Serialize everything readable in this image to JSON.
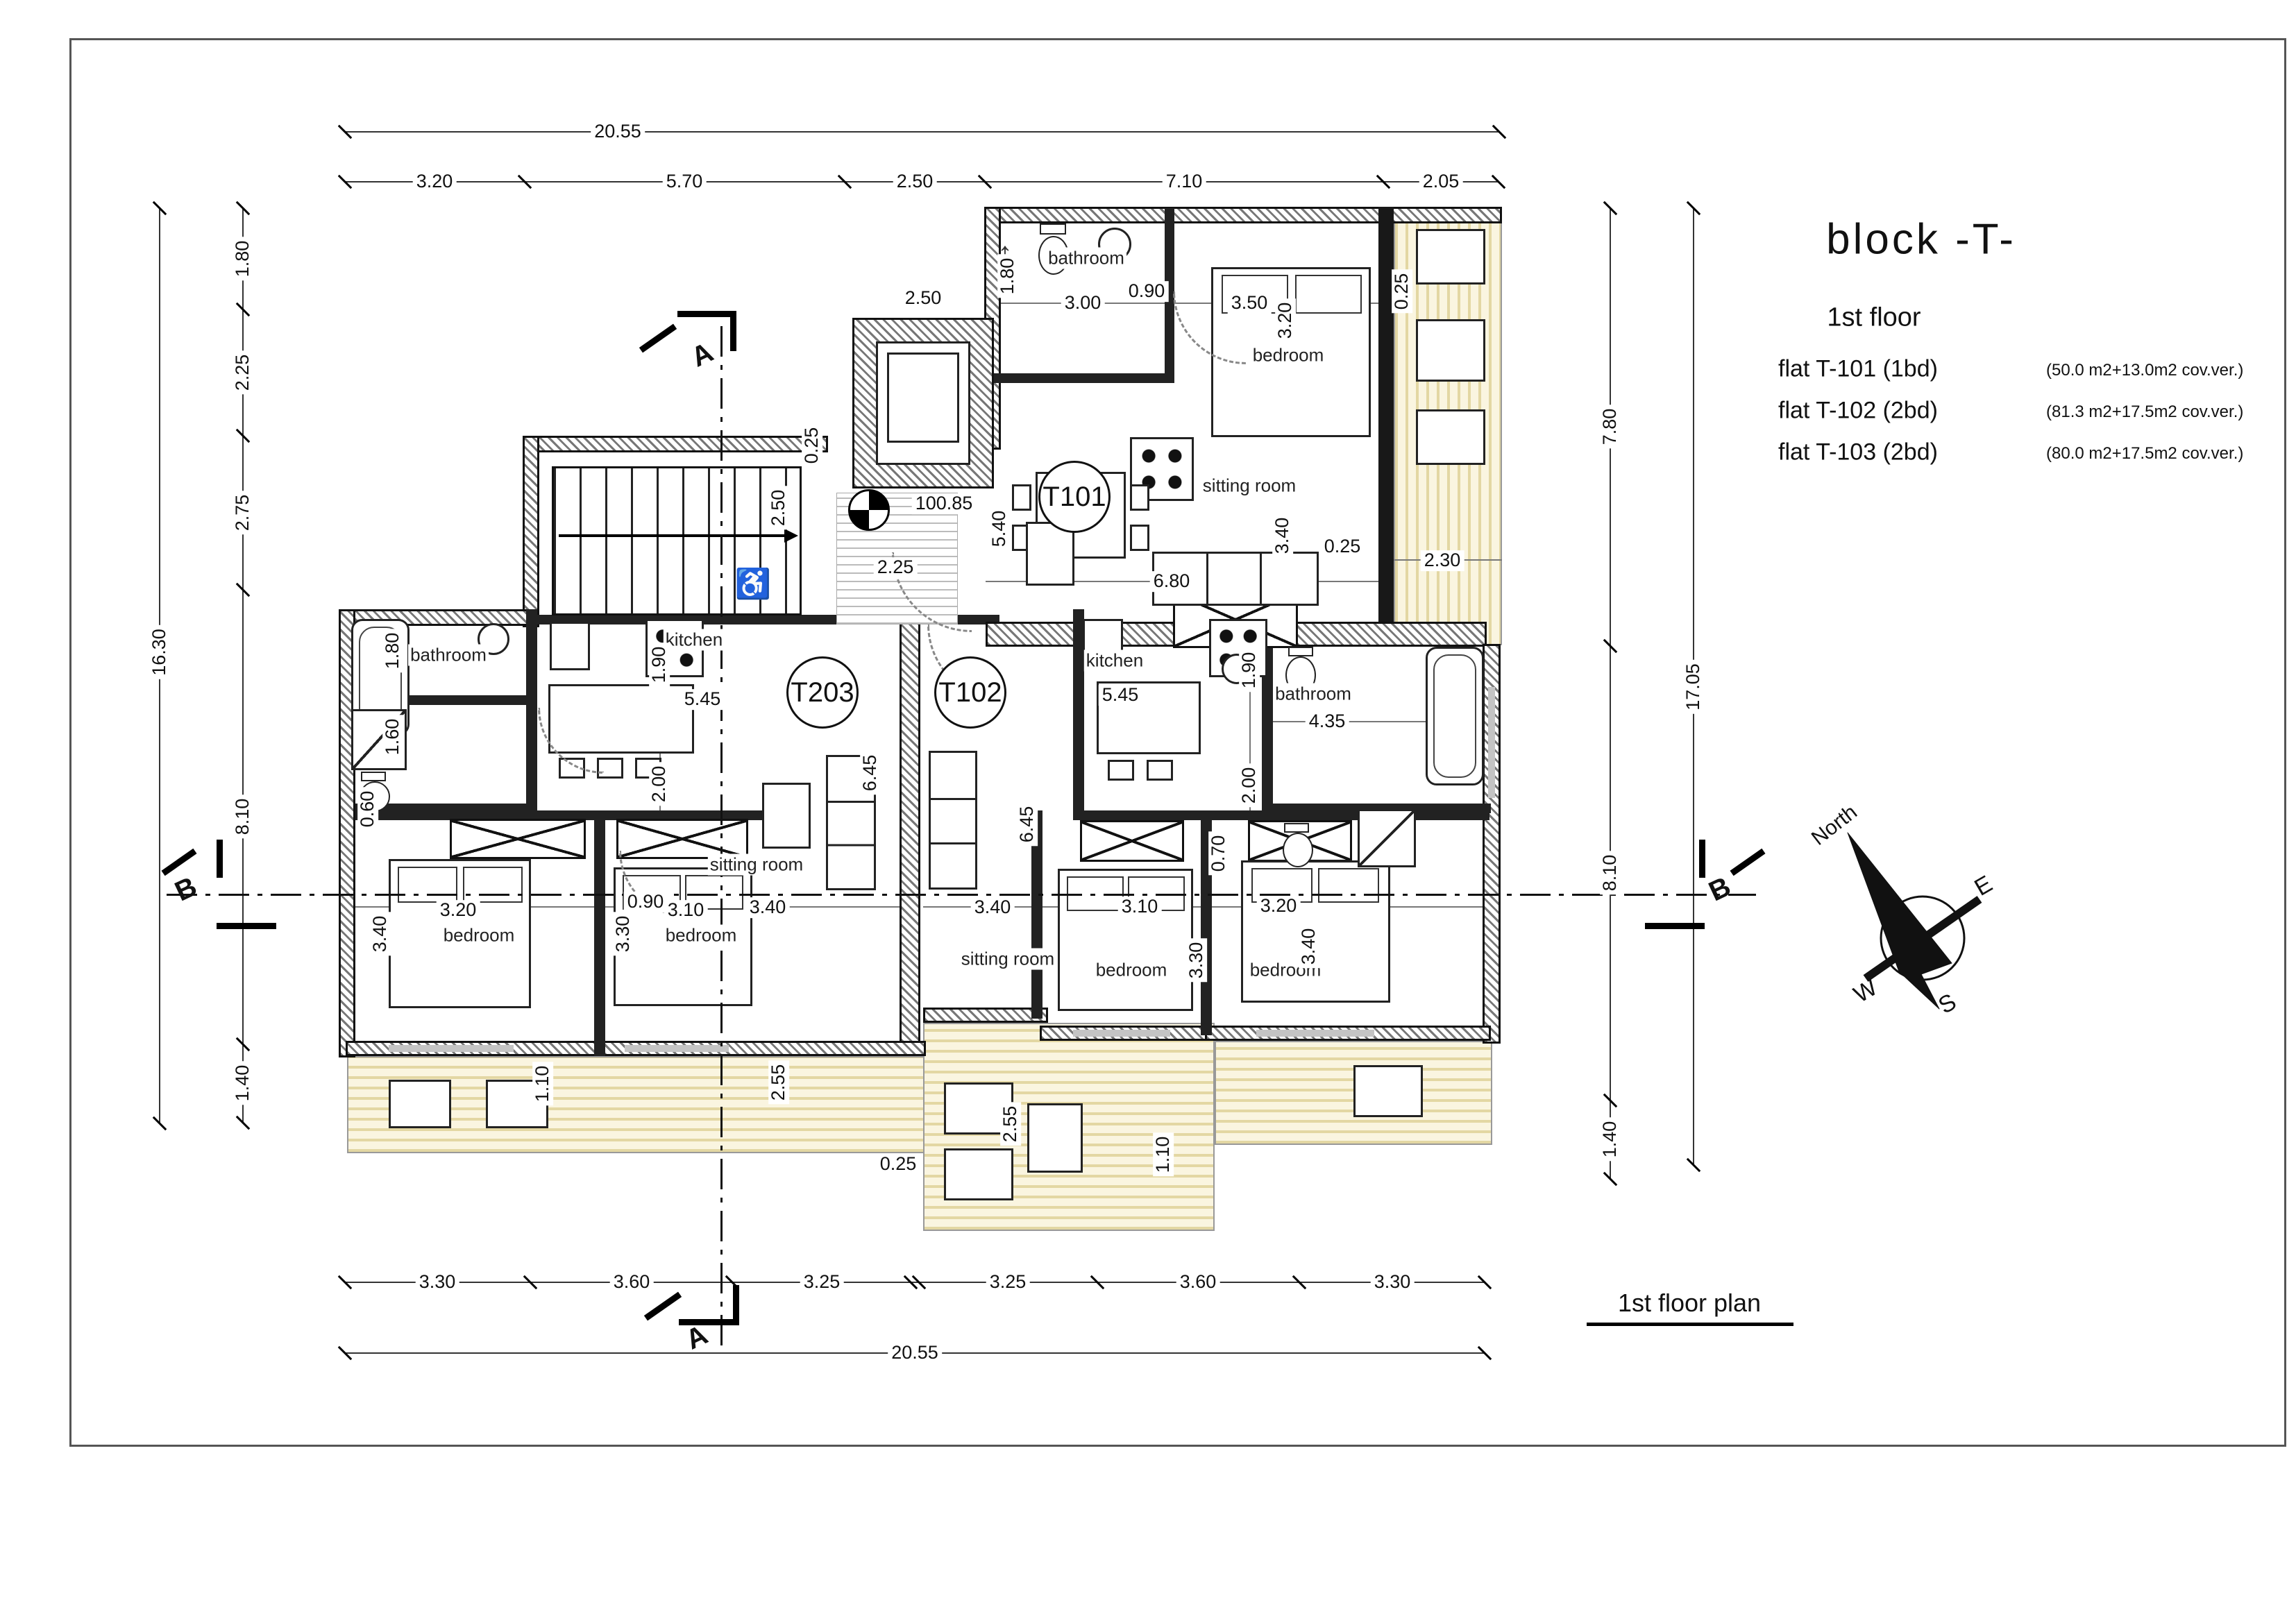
{
  "sheet": {
    "title": "block  -T-",
    "subtitle": "1st floor",
    "flats": [
      {
        "name": "flat T-101 (1bd)",
        "area": "(50.0 m2+13.0m2 cov.ver.)"
      },
      {
        "name": "flat T-102 (2bd)",
        "area": "(81.3 m2+17.5m2 cov.ver.)"
      },
      {
        "name": "flat T-103 (2bd)",
        "area": "(80.0 m2+17.5m2 cov.ver.)"
      }
    ],
    "plan_caption": "1st floor plan"
  },
  "units": {
    "t101": "T101",
    "t203": "T203",
    "t102": "T102"
  },
  "rooms": {
    "bathroom_t101": "bathroom",
    "bedroom_t101": "bedroom",
    "sitting_t101": "sitting room",
    "kitchen_t203": "kitchen",
    "kitchen_t102": "kitchen",
    "bathroom_left": "bathroom",
    "bathroom_right": "bathroom",
    "bedroom_l1": "bedroom",
    "bedroom_l2": "bedroom",
    "sitting_t203": "sitting room",
    "sitting_t102": "sitting room",
    "bedroom_r1": "bedroom",
    "bedroom_r2": "bedroom"
  },
  "dims": {
    "top_total": "20.55",
    "top": [
      "3.20",
      "5.70",
      "2.50",
      "7.10",
      "2.05"
    ],
    "left_total": "16.30",
    "left": [
      "1.80",
      "2.25",
      "2.75",
      "8.10",
      "1.40"
    ],
    "right": [
      "7.80",
      "8.10",
      "1.40"
    ],
    "right_total": "17.05",
    "bottom": [
      "3.30",
      "3.60",
      "3.25",
      "3.25",
      "3.60",
      "3.30"
    ],
    "bottom_total": "20.55",
    "bottom_offset": "0.25"
  },
  "inner": {
    "t101_bath_w": "3.00",
    "t101_entry_h": "1.80",
    "t101_door": "0.90",
    "t101_bed_w": "3.50",
    "t101_bed_h": "3.20",
    "t101_kitchen_h": "5.40",
    "elevator_w": "2.50",
    "landing_w": "2.25",
    "landing_h": "2.50",
    "wall_a": "0.25",
    "wall_b": "0.25",
    "wall_c": "0.25",
    "t101_sit_w": "6.80",
    "t101_sit_h": "3.40",
    "veranda_e_w": "2.30",
    "kitchen1_w": "5.45",
    "kitchen2_w": "5.45",
    "corr_h1": "1.90",
    "corr_h2": "2.00",
    "bath_l_tub": "1.80",
    "bath_l_shower": "1.60",
    "bath_l_wc": "0.60",
    "bed_l1_w": "3.20",
    "bed_l1_h": "3.40",
    "bed_l2_w": "3.10",
    "bed_l2_h": "3.30",
    "door_l": "0.90",
    "sit_t203_w": "3.40",
    "sit_t203_h": "6.45",
    "sit_t102_w": "3.40",
    "sit_t102_h": "6.45",
    "bed_r1_w": "3.10",
    "bed_r1_h": "3.30",
    "bed_r2_w": "3.20",
    "bed_r2_h": "3.40",
    "door_r": "0.70",
    "bath_r_w": "4.35",
    "bath_r_h1": "1.90",
    "bath_r_h2": "2.00",
    "ver_l_d1": "1.10",
    "ver_l_d2": "2.55",
    "ver_r_d1": "2.55",
    "ver_r_d2": "1.10",
    "level": "100.85"
  },
  "sections": {
    "a": "A",
    "b": "B"
  },
  "compass": {
    "north": "North",
    "e": "E",
    "w": "W",
    "s": "S"
  },
  "icons": {
    "up_arrow": "↑",
    "accessible": "♿"
  }
}
